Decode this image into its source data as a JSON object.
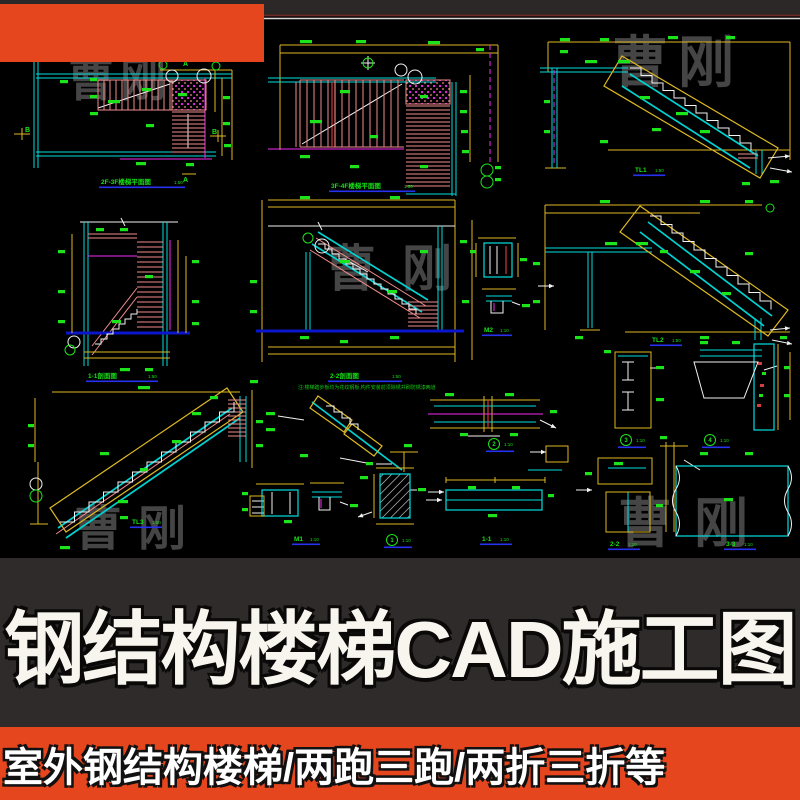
{
  "poster": {
    "main_title": "钢结构楼梯CAD施工图",
    "sub_title": "室外钢结构楼梯/两跑三跑/两折三折等",
    "watermark_text": "曹刚",
    "accent_color": "#e5461e",
    "title_band_color": "#2e2b2a",
    "sheet_background": "#000000"
  },
  "cad_sheet": {
    "palette": {
      "wall_cyan": "#00dede",
      "dimension_yellow": "#dfb922",
      "label_green": "#1be41b",
      "stair_pink": "#f08c8c",
      "axis_magenta": "#f32bf3",
      "ground_blue": "#0b16cc",
      "title_underline_blue": "#2731f0",
      "linework_white": "#f2f2f2",
      "frame_maroon": "#6e2a24"
    },
    "drawing_titles": [
      {
        "text": "2F-3F楼梯平面图",
        "scale": "1:50"
      },
      {
        "text": "3F-4F楼梯平面图",
        "scale": "1:50"
      },
      {
        "text": "TL1",
        "scale": "1:50"
      },
      {
        "text": "1-1剖面图",
        "scale": "1:50"
      },
      {
        "text": "2-2剖面图",
        "scale": "1:50"
      },
      {
        "text": "M2",
        "scale": "1:10"
      },
      {
        "text": "TL2",
        "scale": "1:50"
      },
      {
        "text": "TL3",
        "scale": "1:50"
      },
      {
        "text": "M1",
        "scale": "1:10"
      },
      {
        "text": "1-1",
        "scale": "1:10"
      },
      {
        "text": "2-2",
        "scale": "1:10"
      },
      {
        "text": "3-3",
        "scale": "1:10"
      }
    ],
    "detail_titles": [
      {
        "num": "1",
        "scale": "1:10"
      },
      {
        "num": "2",
        "scale": "1:10"
      },
      {
        "num": "3",
        "scale": "1:10"
      },
      {
        "num": "4",
        "scale": "1:10"
      }
    ],
    "section_marks": {
      "a": "A",
      "b": "B"
    },
    "general_note": "注:楼梯踏步板均为花纹钢板,构件安装前须除锈并刷防锈漆两道"
  }
}
